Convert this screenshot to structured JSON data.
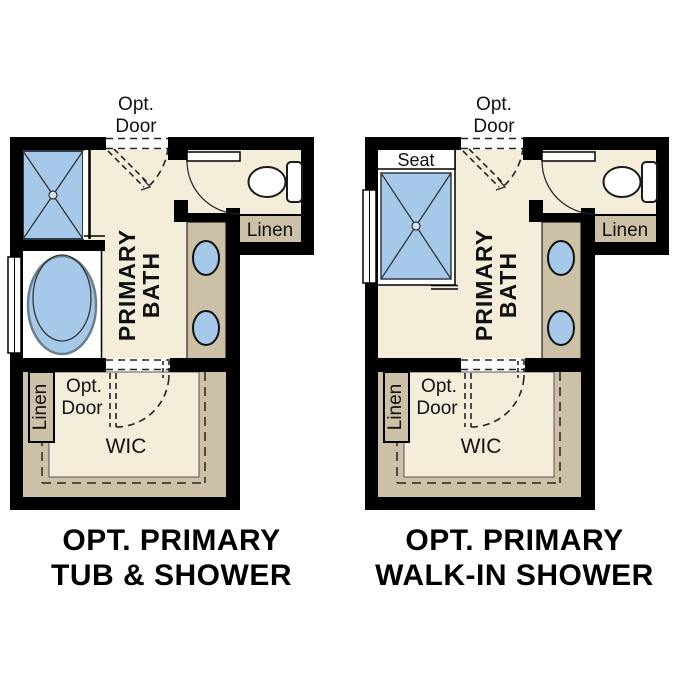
{
  "colors": {
    "floor-cream": "#f4edda",
    "cabinet-tan": "#ccc0a6",
    "fixture-blue": "#a7c9e9",
    "wall-black": "#000000",
    "line-dark": "#222222",
    "caption-black": "#000000"
  },
  "plans": [
    {
      "name": "opt-primary-tub-shower",
      "top_door_line1": "Opt.",
      "top_door_line2": "Door",
      "room_line1": "PRIMARY",
      "room_line2": "BATH",
      "linen_label": "Linen",
      "wic_door_line1": "Opt.",
      "wic_door_line2": "Door",
      "wic_linen_label": "Linen",
      "wic_label": "WIC",
      "caption_line1": "OPT. PRIMARY",
      "caption_line2": "TUB & SHOWER"
    },
    {
      "name": "opt-primary-walk-in-shower",
      "top_door_line1": "Opt.",
      "top_door_line2": "Door",
      "seat_label": "Seat",
      "room_line1": "PRIMARY",
      "room_line2": "BATH",
      "linen_label": "Linen",
      "wic_door_line1": "Opt.",
      "wic_door_line2": "Door",
      "wic_linen_label": "Linen",
      "wic_label": "WIC",
      "caption_line1": "OPT. PRIMARY",
      "caption_line2": "WALK-IN SHOWER"
    }
  ]
}
